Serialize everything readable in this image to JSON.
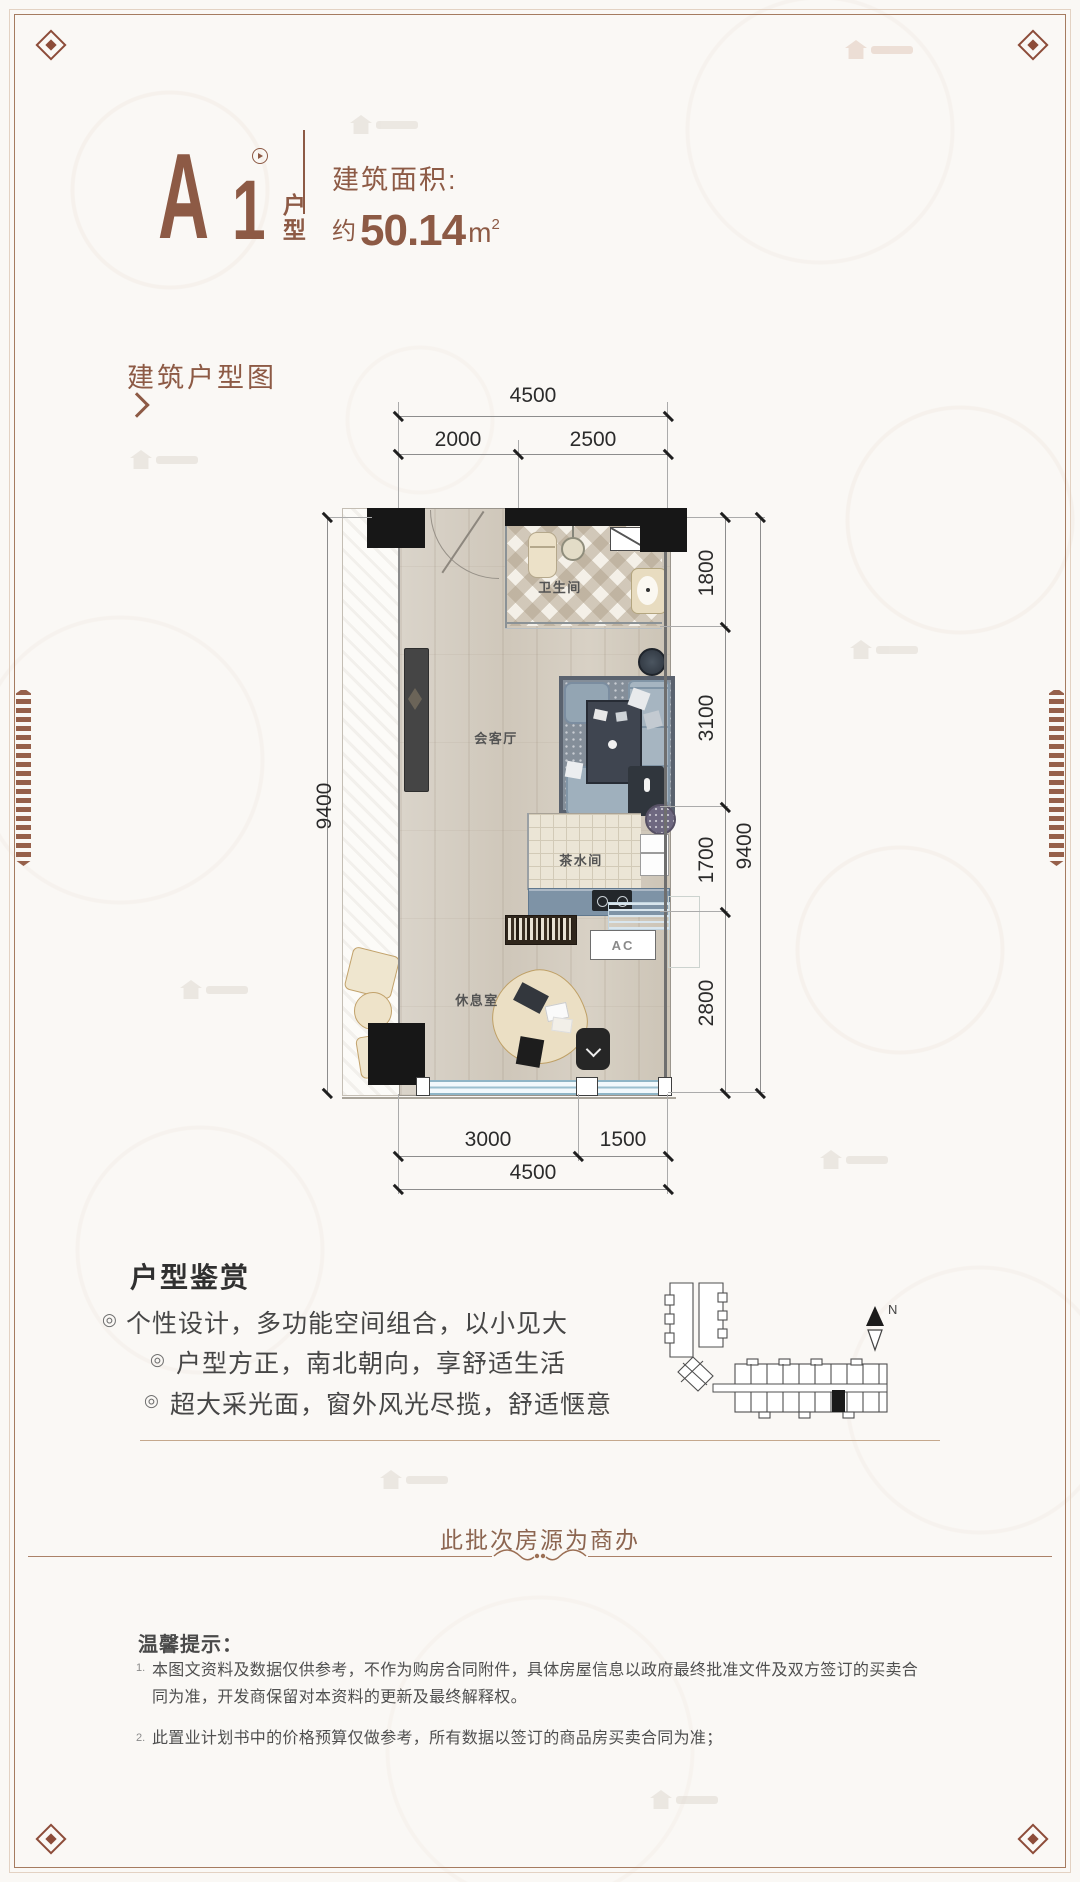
{
  "header": {
    "unit_letter": "A",
    "unit_number": "1",
    "unit_type_chars": [
      "户",
      "型"
    ],
    "area_label": "建筑面积:",
    "area_approx": "约",
    "area_value": "50.14",
    "area_unit": "m",
    "area_exponent": "2"
  },
  "plan_section": {
    "title": "建筑户型图"
  },
  "floorplan": {
    "rooms": {
      "bathroom": "卫生间",
      "living": "会客厅",
      "tea": "茶水间",
      "rest": "休息室"
    },
    "ac_label": "AC",
    "dimensions": {
      "top_total": "4500",
      "top_segments": [
        "2000",
        "2500"
      ],
      "left_total": "9400",
      "right_segments": [
        "1800",
        "3100",
        "1700",
        "2800"
      ],
      "right_total": "9400",
      "bottom_segments": [
        "3000",
        "1500"
      ],
      "bottom_total": "4500"
    }
  },
  "appreciation": {
    "title": "户型鉴赏",
    "bullet_icon": "◎",
    "bullets": [
      "个性设计，多功能空间组合，以小见大",
      "户型方正，南北朝向，享舒适生活",
      "超大采光面，窗外风光尽揽，舒适惬意"
    ]
  },
  "sitemap": {
    "north_label": "N"
  },
  "notice": {
    "text": "此批次房源为商办"
  },
  "tips": {
    "title": "温馨提示：",
    "items": [
      {
        "num": "1.",
        "text": "本图文资料及数据仅供参考，不作为购房合同附件，具体房屋信息以政府最终批准文件及双方签订的买卖合同为准，开发商保留对本资料的更新及最终解释权。"
      },
      {
        "num": "2.",
        "text": "此置业计划书中的价格预算仅做参考，所有数据以签订的商品房买卖合同为准；"
      }
    ]
  },
  "colors": {
    "accent": "#8d5a45",
    "frame": "#a57b60",
    "notice_text": "#8c6550",
    "wall": "#171717",
    "window_blue": "#8fb5c6"
  }
}
